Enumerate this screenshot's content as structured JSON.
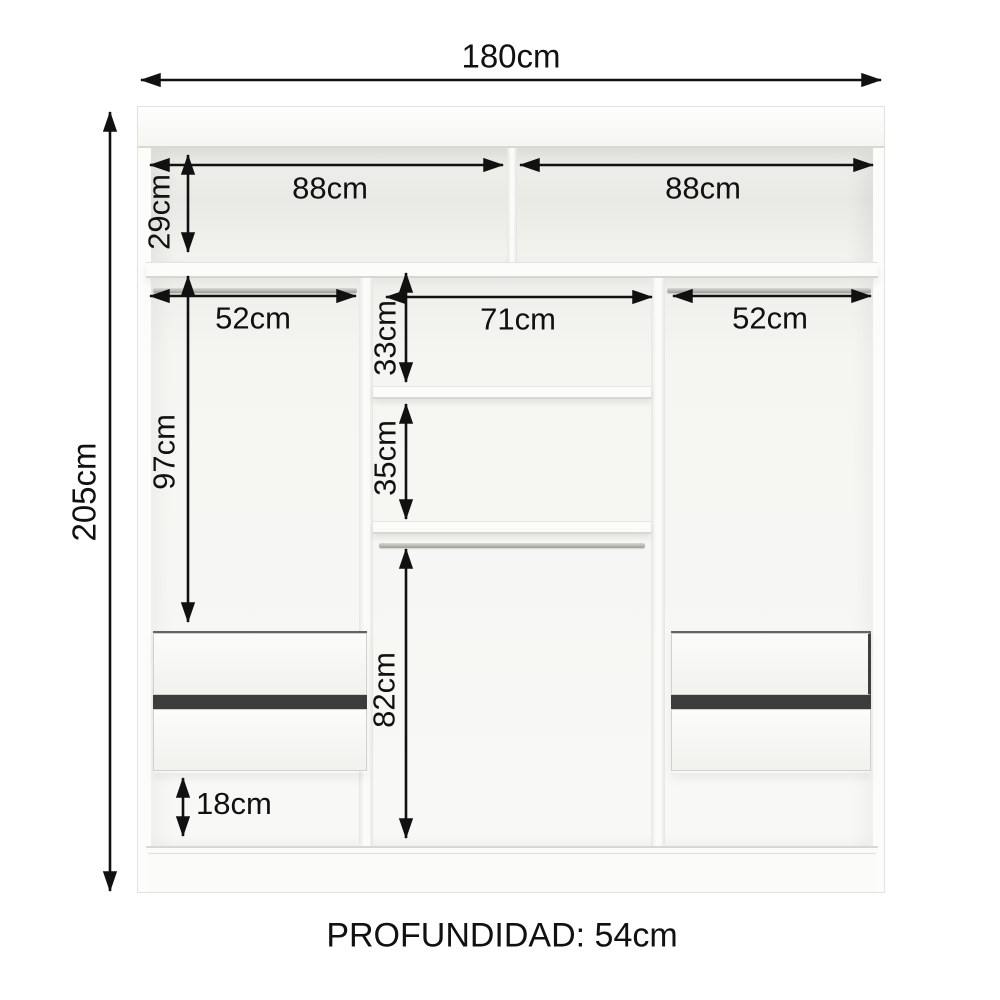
{
  "diagram_type": "wardrobe-internal-dimensions",
  "dimensions": {
    "width_total": "180cm",
    "height_total": "205cm",
    "top_shelf_left": "88cm",
    "top_shelf_right": "88cm",
    "top_section_height": "29cm",
    "left_column_width": "52cm",
    "center_column_width": "71cm",
    "right_column_width": "52cm",
    "center_upper_shelf_height": "33cm",
    "center_lower_shelf_height": "35cm",
    "side_hanging_height": "97cm",
    "center_hanging_height": "82cm",
    "bottom_space_height": "18cm",
    "depth_label": "PROFUNDIDAD: 54cm"
  },
  "colors": {
    "background": "#ffffff",
    "dimension_lines": "#111111",
    "cabinet_surface": "#fcfcfb",
    "cabinet_shadow": "#e9e9e5",
    "drawer_gap": "#3c3c3c",
    "hanging_rod": "#a8a8a3"
  }
}
